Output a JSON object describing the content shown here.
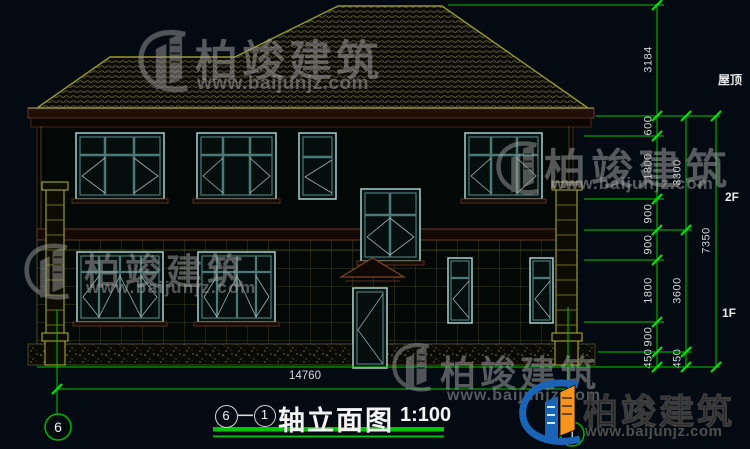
{
  "page": {
    "background": "#030a12",
    "colors": {
      "cad_green": "#00c400",
      "cad_olive": "#94942e",
      "dim_text": "#d9d9d9",
      "window_teal": "#a8cfcf"
    }
  },
  "brand": {
    "name": "柏竣建筑",
    "url": "www.baijunjz.com"
  },
  "levels": {
    "roof": "屋顶",
    "f2": "2F",
    "f1": "1F"
  },
  "dims": {
    "col1": [
      "3184",
      "600",
      "1800",
      "900",
      "900",
      "1800",
      "900",
      "450"
    ],
    "col2": [
      "3300",
      "3600",
      "450"
    ],
    "col3": [
      "7350"
    ],
    "bottom": "14760"
  },
  "axis": {
    "left": "6",
    "right": "1"
  },
  "title": {
    "start": "6",
    "end": "1",
    "name": "轴立面图",
    "scale": "1:100"
  }
}
